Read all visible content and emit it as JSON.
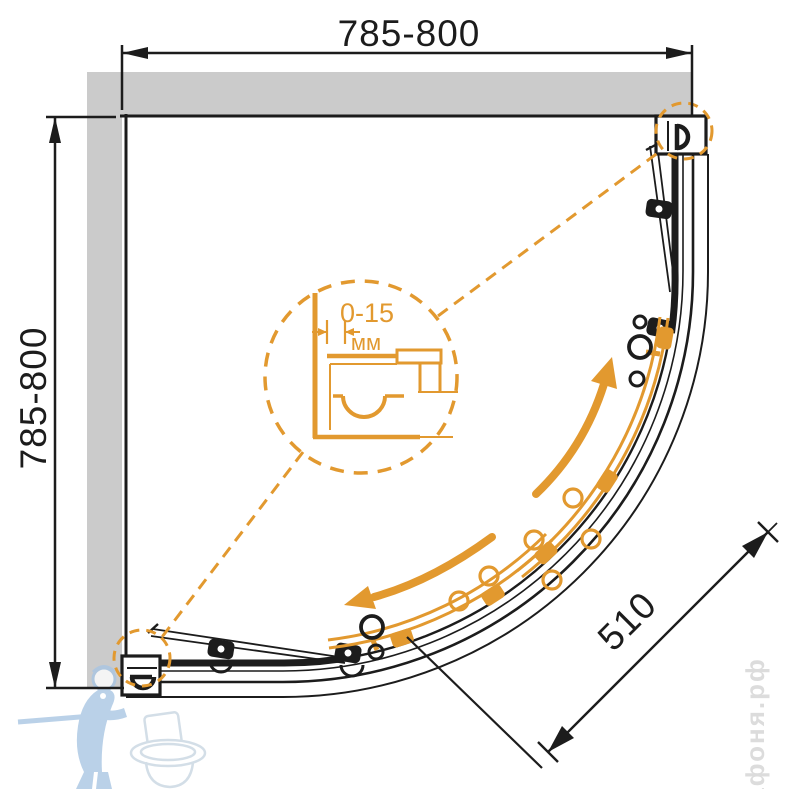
{
  "drawing": {
    "type": "technical-drawing",
    "subject": "quadrant corner shower enclosure - plan view",
    "dimensions": {
      "top_width": "785-800",
      "left_height": "785-800",
      "diagonal_door": "510",
      "adjustment_range": "0-15",
      "adjustment_unit": "мм"
    },
    "watermark": {
      "brand_vertical_text": "афоня.рф",
      "logo": "plumber-with-toilet"
    },
    "colors": {
      "accent_orange": "#e2992f",
      "line_black": "#1c1c1c",
      "wall_gray": "#cbcbcb",
      "watermark_blue": "#a9c6e3",
      "watermark_light_gray": "#dcdcdc"
    },
    "icons": {
      "detail_magnifier": "dashed-circle-zoom",
      "slide_direction": "curved-double-arrows",
      "corner_details": "dashed-callout-circles"
    }
  }
}
